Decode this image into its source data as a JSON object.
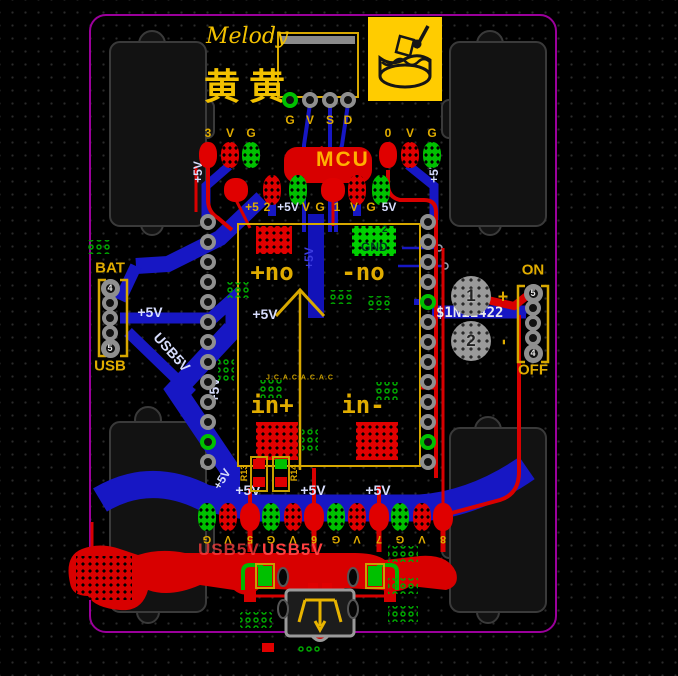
{
  "canvas": {
    "width": 678,
    "height": 676
  },
  "silkscreen": {
    "brand": "Melody",
    "brand_cn": "黄黄",
    "mcu": "MCU",
    "usb5v_1": "USB5V",
    "usb5v_2": "USB5V",
    "small_text": "J.C.A.C.A.C.A.C"
  },
  "icons": {
    "logo": "cake-icon"
  },
  "display_header": {
    "pins": [
      "G",
      "V",
      "S",
      "D"
    ]
  },
  "top_row": {
    "labels": [
      "3",
      "V",
      "G",
      "0",
      "V",
      "G"
    ]
  },
  "row2": {
    "labels": [
      "+5",
      "2",
      "+5V",
      "V",
      "G",
      "1",
      "V",
      "G",
      "5V"
    ]
  },
  "bottom_row": {
    "labels": [
      "G",
      "V",
      "5",
      "G",
      "V",
      "6",
      "G",
      "V",
      "7",
      "G",
      "V",
      "8"
    ]
  },
  "bat_header": {
    "top": "BAT",
    "bottom": "USB",
    "first_pin": "4",
    "last_pin": "5"
  },
  "on_header": {
    "top": "ON",
    "bottom": "OFF",
    "first_pin": "5",
    "last_pin": "4",
    "plus": "+",
    "minus": "-"
  },
  "big_pads": {
    "pad1": "1",
    "pad2": "2"
  },
  "module": {
    "gnd": "GND",
    "gnd_pin": "2",
    "on_plus": "+no",
    "on_minus": "-no",
    "in_plus": "in+",
    "in_minus": "in-",
    "r13": "R13",
    "r14": "R14"
  },
  "nets": {
    "p5v": "+5V",
    "v5": "5V",
    "usb5v": "USB5V",
    "diode": "$1N11422"
  },
  "colors": {
    "copper_top": "#d80000",
    "copper_bottom": "#1717c4",
    "silk": "#e0ac00",
    "pad_green": "#00c000",
    "board_outline": "#9b009b",
    "logo_bg": "#ffcc00"
  }
}
